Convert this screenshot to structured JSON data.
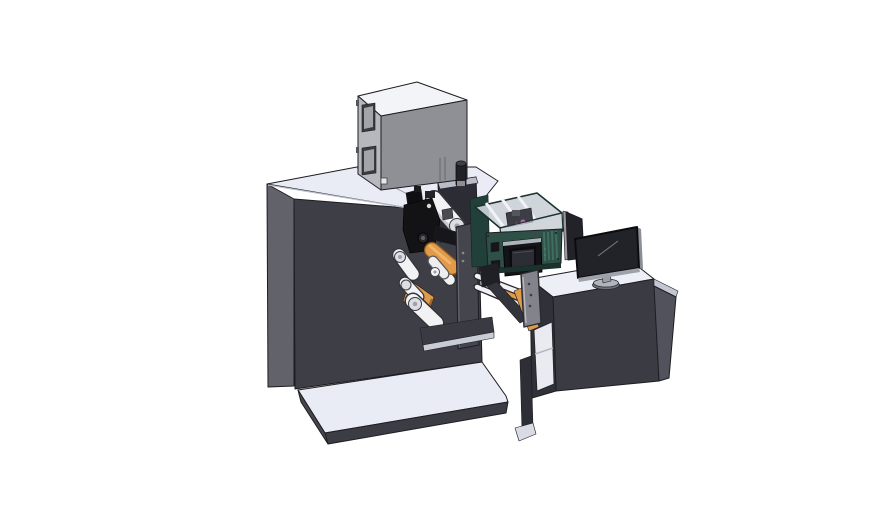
{
  "scene": {
    "description": "3D CAD render of an industrial label printing machine with unwinder rollers, a print head, a protective enclosure with HMI touchscreen, and an operator desk with monitor",
    "background": "#ffffff",
    "parts": [
      {
        "name": "machine-top-box",
        "label": "electronics cabinet box",
        "color": "#8f9096"
      },
      {
        "name": "machine-body",
        "label": "main machine cabinet",
        "color": "#3e3e46"
      },
      {
        "name": "base-platform",
        "label": "floor base platform",
        "color": "#e9ecf5"
      },
      {
        "name": "print-head",
        "label": "print head mechanism",
        "color": "#131316"
      },
      {
        "name": "unwinder-rollers",
        "label": "web guide rollers",
        "color": "#f2f2f5"
      },
      {
        "name": "label-web-roll",
        "label": "label web roll (orange)",
        "color": "#e09a48"
      },
      {
        "name": "side-plate",
        "label": "front mounting plate",
        "color": "#45454e"
      },
      {
        "name": "control-enclosure",
        "label": "teal control enclosure with clear cover",
        "color": "#2e5046"
      },
      {
        "name": "hmi-screen",
        "label": "HMI touch panel",
        "color": "#141418"
      },
      {
        "name": "operator-desk",
        "label": "operator desk cabinet",
        "color": "#3b3b44"
      },
      {
        "name": "desk-monitor",
        "label": "desktop monitor",
        "color": "#222229"
      },
      {
        "name": "side-screen-panel",
        "label": "secondary screen panel",
        "color": "#27272e"
      }
    ]
  },
  "colors": {
    "background": "#ffffff",
    "outline": "#1d1d22",
    "machine_top": "#e9ecf4",
    "machine_left": "#62626b",
    "machine_front": "#3e3e46",
    "tower_front": "#2c2c34",
    "tower_top": "#b9bdc7",
    "platform_top": "#e9ecf5",
    "platform_front": "#3c3c44",
    "platform_left": "#46464e",
    "box_top": "#f3f4f7",
    "box_left": "#b7b8be",
    "box_front": "#8f9096",
    "window_frame": "#3a3a40",
    "window_glass": "#a2a4aa",
    "desk_top": "#edeff6",
    "desk_front": "#3b3b44",
    "desk_side": "#52525c",
    "desk_opening": "#e9ebf1",
    "teal_front": "#2e5046",
    "teal_dark": "#1b332c",
    "tray_interior": "#ccd1d9",
    "rib_white": "#f1f3f6",
    "hmi_body": "#141418",
    "hmi_screen": "#2d2d35",
    "roller_white": "#f2f2f5",
    "roller_cap": "#dcdee3",
    "web_orange": "#e09a48",
    "web_orange_dark": "#a06a26",
    "plate_gray": "#45454e",
    "bracket_gray": "#83838b",
    "monitor_screen": "#222229",
    "monitor_base": "#b0b4bc",
    "accent_magenta": "#c85ab5",
    "black_part": "#131316"
  }
}
